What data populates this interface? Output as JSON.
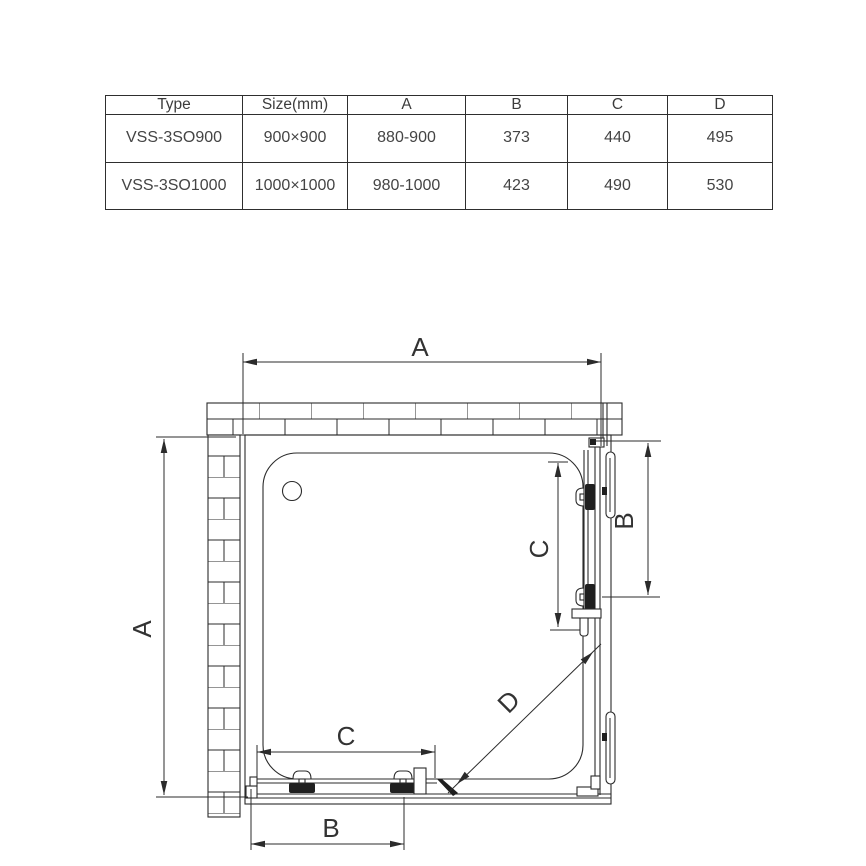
{
  "table": {
    "headers": [
      "Type",
      "Size(mm)",
      "A",
      "B",
      "C",
      "D"
    ],
    "rows": [
      [
        "VSS-3SO900",
        "900×900",
        "880-900",
        "373",
        "440",
        "495"
      ],
      [
        "VSS-3SO1000",
        "1000×1000",
        "980-1000",
        "423",
        "490",
        "530"
      ]
    ]
  },
  "diagram": {
    "labels": {
      "width_top": "A",
      "height_left": "A",
      "door_right": "C",
      "panel_right": "B",
      "door_bottom": "C",
      "panel_bottom": "B",
      "diagonal": "D"
    },
    "line_color": "#2b2b2b"
  }
}
